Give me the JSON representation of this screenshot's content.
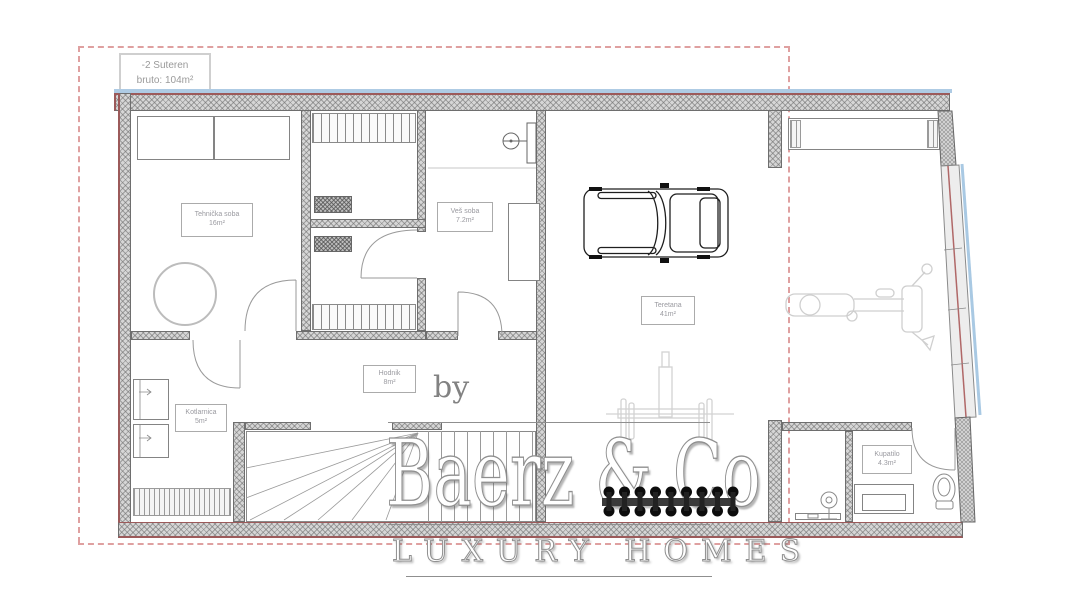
{
  "plan": {
    "level_label": {
      "line1": "-2 Suteren",
      "line2": "bruto: 104m²"
    },
    "rooms": [
      {
        "name": "Tehnička soba",
        "area": "16m²"
      },
      {
        "name": "Veš soba",
        "area": "7.2m²"
      },
      {
        "name": "Teretana",
        "area": "41m²"
      },
      {
        "name": "Hodnik",
        "area": "8m²"
      },
      {
        "name": "Kotlarnica",
        "area": "5m²"
      },
      {
        "name": "Kupatilo",
        "area": "4.3m²"
      }
    ],
    "fixtures": [
      "car",
      "wardrobe",
      "boiler-tank",
      "stairs",
      "squat-rack",
      "barbell",
      "dumbbell-rack",
      "exercise-machine",
      "toilet",
      "washbasin",
      "vanity",
      "floor-grille"
    ]
  },
  "watermark": {
    "by": "by",
    "brand": "Baerz & Co",
    "tagline": "LUXURY HOMES"
  },
  "colors": {
    "wall_outline_red": "#9c5a5a",
    "glass_blue": "#a9c9e3",
    "boundary_dashed_pink": "#dfa0a0",
    "wall_fill_gray": "#d6d6d6",
    "equipment_gray": "#d2d2d2",
    "label_text_gray": "#9a9aa0",
    "watermark_gray": "#8f8f8f"
  }
}
